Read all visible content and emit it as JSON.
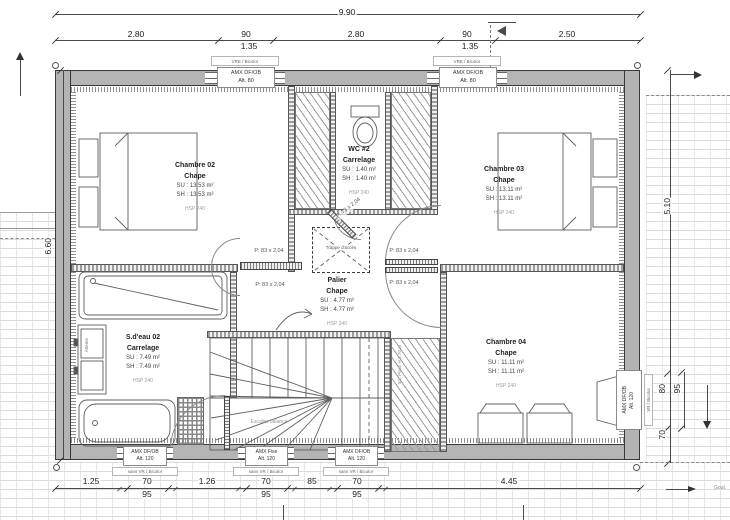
{
  "dims": {
    "total_width": "9.90",
    "row2": {
      "a": "2.80",
      "b": "90",
      "b_sub": "1.35",
      "c": "2.80",
      "d": "90",
      "d_sub": "1.35",
      "e": "2.50"
    },
    "marker": "A",
    "left_height": "6.60",
    "right_height": "5.10",
    "right_lower": {
      "w": "80",
      "f": "95",
      "b": "70"
    },
    "bottom": {
      "a": "1.25",
      "b": "70",
      "b_sub": "95",
      "c": "1.26",
      "d": "70",
      "d_sub": "95",
      "e": "85",
      "f": "70",
      "f_sub": "95",
      "g": "4.45"
    }
  },
  "rooms": {
    "chambre02": {
      "name": "Chambre 02",
      "finish": "Chape",
      "su": "SU : 13.53 m²",
      "sh": "SH : 13.53 m²",
      "hsp": "HSP 240"
    },
    "wc": {
      "name": "WC #2",
      "finish": "Carrelage",
      "su": "SU : 1.40 m²",
      "sh": "SH : 1.40 m²",
      "hsp": "HSP 240"
    },
    "chambre03": {
      "name": "Chambre 03",
      "finish": "Chape",
      "su": "SU : 13.11 m²",
      "sh": "SH : 13.11 m²",
      "hsp": "HSP 240"
    },
    "palier": {
      "name": "Palier",
      "finish": "Chape",
      "su": "SU : 4.77 m²",
      "sh": "SH : 4.77 m²",
      "hsp": "HSP 240"
    },
    "sdeau": {
      "name": "S.d'eau 02",
      "finish": "Carrelage",
      "su": "SU : 7.49 m²",
      "sh": "SH : 7.49 m²",
      "hsp": "HSP 240"
    },
    "chambre04": {
      "name": "Chambre 04",
      "finish": "Chape",
      "su": "SU : 11.11 m²",
      "sh": "SH : 11.11 m²",
      "hsp": "HSP 240"
    }
  },
  "windows": {
    "top_left": {
      "line1": "AMX DF/OB",
      "line2": "Alt. 80",
      "tag": "VRE / Bicolor"
    },
    "top_right": {
      "line1": "AMX DF/OB",
      "line2": "Alt. 80",
      "tag": "VRE / Bicolor"
    },
    "bottom_left": {
      "line1": "AMX DF/OB",
      "line2": "Alt. 120",
      "tag": "sans VR / Bicolor"
    },
    "bottom_middle": {
      "line1": "AMX Fixe",
      "line2": "Alt. 120",
      "tag": "sans VR / Bicolor"
    },
    "bottom_right": {
      "line1": "AMX DF/OB",
      "line2": "Alt. 120",
      "tag": "sans VR / Bicolor"
    },
    "right": {
      "line1": "AMX DF/OB",
      "line2": "Alt. 120",
      "tag": "VR / Bicolor"
    }
  },
  "doors": {
    "chambre02_a": "P: 83 x 2,04",
    "chambre02_b": "P: 83 x 2,04",
    "chambre03": "P: 83 x 2,04",
    "chambre04": "P: 83 x 2,04",
    "wc": "P: 73 x 2,04"
  },
  "annotations": {
    "trappe": "Trappe d'accès",
    "stairs": "Escalier balancé",
    "stairs_note": "SC: Placo H 1.70 m",
    "attente": "Attente",
    "gutter": "Gout."
  }
}
